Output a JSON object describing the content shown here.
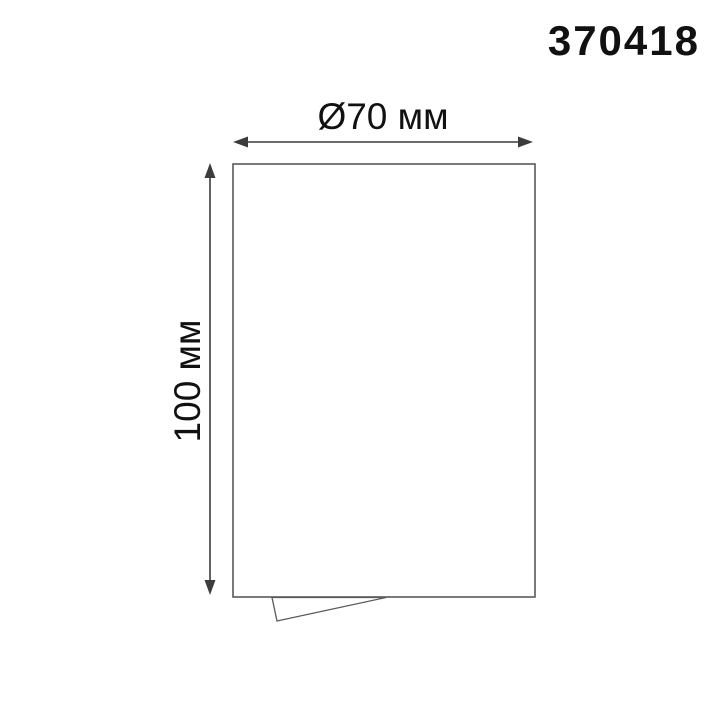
{
  "drawing": {
    "product_code": "370418",
    "dimensions": {
      "diameter": {
        "label": "Ø70 мм",
        "value_mm": 70
      },
      "height": {
        "label": "100 мм",
        "value_mm": 100
      }
    },
    "colors": {
      "background": "#ffffff",
      "line": "#5a5a5a",
      "dimension_line": "#3c3c3c",
      "text": "#111111"
    }
  }
}
